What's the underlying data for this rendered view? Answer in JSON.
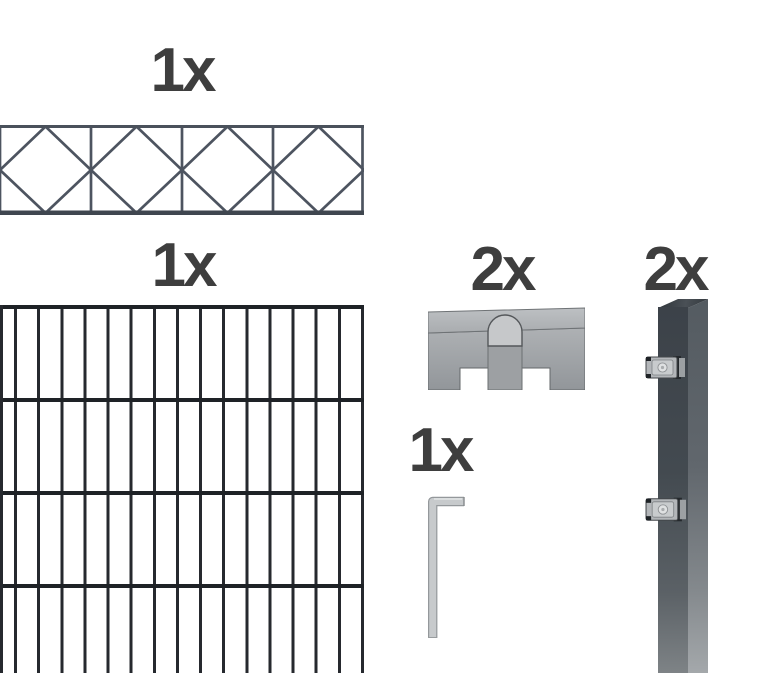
{
  "page": {
    "background": "#ffffff"
  },
  "labels": {
    "deco_panel": "1x",
    "mesh_panel": "1x",
    "connectors": "2x",
    "posts": "2x",
    "hex_key": "1x"
  },
  "colors": {
    "label_text": "#3e3e3e",
    "deco_stroke": "#4d5460",
    "deco_rail": "#454c56",
    "mesh_bar": "#26292e",
    "mesh_rail": "#1e2226",
    "post_front": "#41474d",
    "post_side": "#5f656b",
    "metal_light": "#c6c9cb",
    "metal_mid": "#a8abae"
  },
  "items": [
    {
      "id": "decorative-panel",
      "count_label": "1x"
    },
    {
      "id": "mesh-panel",
      "count_label": "1x"
    },
    {
      "id": "connector-brackets",
      "count_label": "2x"
    },
    {
      "id": "posts-with-clamps",
      "count_label": "2x"
    },
    {
      "id": "hex-key",
      "count_label": "1x"
    }
  ]
}
